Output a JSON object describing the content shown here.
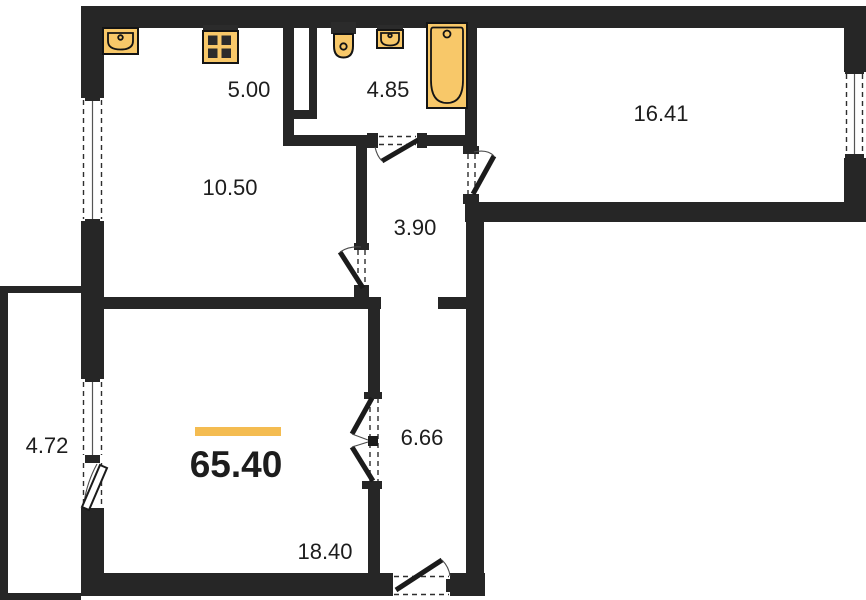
{
  "title": "Apartment floor plan",
  "total": {
    "area": "65.40"
  },
  "rooms": {
    "kitchen_niche": {
      "area": "5.00"
    },
    "bathroom": {
      "area": "4.85"
    },
    "bedroom": {
      "area": "16.41"
    },
    "kitchen": {
      "area": "10.50"
    },
    "hallway": {
      "area": "3.90"
    },
    "balcony": {
      "area": "4.72"
    },
    "corridor": {
      "area": "6.66"
    },
    "living_room": {
      "area": "18.40"
    }
  },
  "fixtures": [
    "kitchen-sink-icon",
    "stove-icon",
    "toilet-icon",
    "washbasin-icon",
    "bathtub-icon"
  ],
  "colors": {
    "background": "#ffffff",
    "wall": "#262626",
    "fixture": "#F8C869",
    "accent": "#F4BC51",
    "text": "#1d1d1d"
  }
}
